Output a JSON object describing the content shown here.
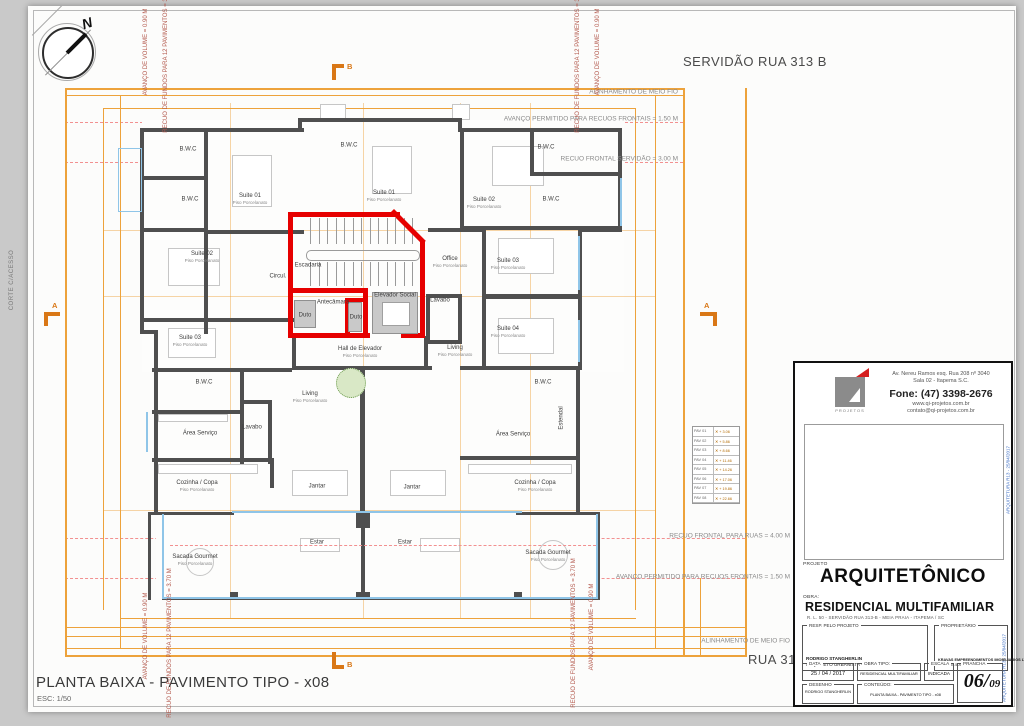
{
  "sheet": {
    "plan_title": "PLANTA BAIXA - PAVIMENTO TIPO - x08",
    "scale_label": "ESC: 1/50",
    "edge_label": "CORTE C/ACESSO",
    "compass_label": "N"
  },
  "streets": {
    "top": "SERVIDÃO RUA 313 B",
    "bottom": "RUA 315"
  },
  "margin_notes": [
    {
      "text": "ALINHAMENTO DE MEIO FIO",
      "x": 678,
      "y": 92
    },
    {
      "text": "AVANÇO PERMITIDO PARA RECUOS FRONTAIS = 1.50 M",
      "x": 678,
      "y": 119
    },
    {
      "text": "RECUO FRONTAL SERVIDÃO = 3.00 M",
      "x": 678,
      "y": 159
    },
    {
      "text": "RECUO FRONTAL PARA RUAS = 4.00 M",
      "x": 790,
      "y": 536
    },
    {
      "text": "AVANÇO PERMITIDO PARA RECUOS FRONTAIS = 1.50 M",
      "x": 790,
      "y": 577
    },
    {
      "text": "ALINHAMENTO DE MEIO FIO",
      "x": 790,
      "y": 641
    }
  ],
  "vertical_notes": [
    {
      "text": "AVANÇO DE VOLUME = 0.90 M",
      "x": 146,
      "y": 52
    },
    {
      "text": "RECUO DE FUNDOS PARA 12 PAVIMENTOS = 3.70 M",
      "x": 166,
      "y": 58
    },
    {
      "text": "RECUO DE FUNDOS PARA 12 PAVIMENTOS = 3.70 M",
      "x": 578,
      "y": 58
    },
    {
      "text": "AVANÇO DE VOLUME = 0.90 M",
      "x": 598,
      "y": 52
    },
    {
      "text": "AVANÇO DE VOLUME = 0.90 M",
      "x": 146,
      "y": 636
    },
    {
      "text": "RECUO DE FUNDOS PARA 12 PAVIMENTOS = 3.70 M",
      "x": 170,
      "y": 643
    },
    {
      "text": "RECUO DE FUNDOS PARA 12 PAVIMENTOS = 3.70 M",
      "x": 574,
      "y": 633
    },
    {
      "text": "AVANÇO DE VOLUME = 0.90 M",
      "x": 592,
      "y": 627
    }
  ],
  "section_markers": [
    {
      "label": "A",
      "x": 44,
      "y": 312,
      "dir": "left"
    },
    {
      "label": "A",
      "x": 700,
      "y": 312,
      "dir": "right"
    },
    {
      "label": "B",
      "x": 332,
      "y": 64,
      "dir": "top"
    },
    {
      "label": "B",
      "x": 332,
      "y": 652,
      "dir": "bottom"
    }
  ],
  "rooms": [
    {
      "name": "B.W.C",
      "x": 188,
      "y": 150
    },
    {
      "name": "B.W.C",
      "x": 190,
      "y": 200
    },
    {
      "name": "Suite 01",
      "x": 250,
      "y": 199,
      "sub": "Piso Porcelanato"
    },
    {
      "name": "B.W.C",
      "x": 349,
      "y": 146
    },
    {
      "name": "Suite 01",
      "x": 384,
      "y": 196,
      "sub": "Piso Porcelanato"
    },
    {
      "name": "Suite 02",
      "x": 202,
      "y": 257,
      "sub": "Piso Porcelanato"
    },
    {
      "name": "Suite 03",
      "x": 190,
      "y": 341,
      "sub": "Piso Porcelanato"
    },
    {
      "name": "Circul.",
      "x": 278,
      "y": 277
    },
    {
      "name": "Escadaria",
      "x": 308,
      "y": 266
    },
    {
      "name": "Antecâmara",
      "x": 333,
      "y": 303
    },
    {
      "name": "Duto",
      "x": 305,
      "y": 316
    },
    {
      "name": "Duto",
      "x": 356,
      "y": 318
    },
    {
      "name": "Elevador Social",
      "x": 395,
      "y": 296
    },
    {
      "name": "Hall de Elevador",
      "x": 360,
      "y": 352,
      "sub": "Piso Porcelanato"
    },
    {
      "name": "Office",
      "x": 450,
      "y": 262,
      "sub": "Piso Porcelanato"
    },
    {
      "name": "Lavabo",
      "x": 440,
      "y": 301
    },
    {
      "name": "Living",
      "x": 455,
      "y": 351,
      "sub": "Piso Porcelanato"
    },
    {
      "name": "B.W.C",
      "x": 546,
      "y": 148
    },
    {
      "name": "Suite 02",
      "x": 484,
      "y": 203,
      "sub": "Piso Porcelanato"
    },
    {
      "name": "B.W.C",
      "x": 551,
      "y": 200
    },
    {
      "name": "Suite 03",
      "x": 508,
      "y": 264,
      "sub": "Piso Porcelanato"
    },
    {
      "name": "Suite 04",
      "x": 508,
      "y": 332,
      "sub": "Piso Porcelanato"
    },
    {
      "name": "B.W.C",
      "x": 204,
      "y": 383
    },
    {
      "name": "Área Serviço",
      "x": 200,
      "y": 434
    },
    {
      "name": "Lavabo",
      "x": 252,
      "y": 428
    },
    {
      "name": "Living",
      "x": 310,
      "y": 397,
      "sub": "Piso Porcelanato"
    },
    {
      "name": "Cozinha / Copa",
      "x": 197,
      "y": 486,
      "sub": "Piso Porcelanato"
    },
    {
      "name": "Jantar",
      "x": 317,
      "y": 487
    },
    {
      "name": "Jantar",
      "x": 412,
      "y": 488
    },
    {
      "name": "Estar",
      "x": 317,
      "y": 543
    },
    {
      "name": "Estar",
      "x": 405,
      "y": 543
    },
    {
      "name": "Sacada Gourmet",
      "x": 195,
      "y": 560,
      "sub": "Piso Porcelanato"
    },
    {
      "name": "B.W.C",
      "x": 543,
      "y": 383
    },
    {
      "name": "Estendal",
      "x": 562,
      "y": 418,
      "rot": true
    },
    {
      "name": "Área Serviço",
      "x": 513,
      "y": 435
    },
    {
      "name": "Cozinha / Copa",
      "x": 535,
      "y": 486,
      "sub": "Piso Porcelanato"
    },
    {
      "name": "Sacada Gourmet",
      "x": 548,
      "y": 556,
      "sub": "Piso Porcelanato"
    }
  ],
  "levels_table": {
    "rows": [
      [
        "PAV 01",
        "+ 3.06"
      ],
      [
        "PAV 02",
        "+ 5.86"
      ],
      [
        "PAV 03",
        "+ 8.66"
      ],
      [
        "PAV 04",
        "+ 11.46"
      ],
      [
        "PAV 05",
        "+ 14.26"
      ],
      [
        "PAV 06",
        "+ 17.06"
      ],
      [
        "PAV 07",
        "+ 19.86"
      ],
      [
        "PAV 08",
        "+ 22.66"
      ]
    ]
  },
  "title_block": {
    "logo_caption": "PROJETOS",
    "address1": "Av. Nereu Ramos esq. Rua 208 nº 3040",
    "address2": "Sala 02 - Itapema S.C.",
    "phone": "Fone: (47) 3398-2676",
    "site": "www.qi-projetos.com.br",
    "email": "contato@qi-projetos.com.br",
    "projeto_label": "PROJETO",
    "projeto": "ARQUITETÔNICO",
    "obra_label": "OBRA:",
    "obra": "RESIDENCIAL MULTIFAMILIAR",
    "obra_sub": "R. L. 50 - SERVIDÃO RUA 313-B - MEIA PRAIA - ITAPEMA / SC",
    "resp_label": "RESP. PELO PROJETO",
    "resp_line1": "RODRIGO STANGHERLIN",
    "resp_line2": "ARQUITETO URBANISTA - CAU A48954",
    "prop_label": "PROPRIETÁRIO",
    "prop_line1": "KRAVAS EMPREENDIMENTOS IMOBILIARIOS LTDA",
    "prop_line2": "CNPJ: 05.505.505/0001-05",
    "data_label": "DATA",
    "data_value": "25 / 04 / 2017",
    "tipo_label": "OBRA  TIPO:",
    "tipo_value": "RESIDENCIAL MULTIFAMILIAR",
    "escala_label": "ESCALA",
    "escala_value": "INDICADA",
    "prancha_label": "PRANCHA",
    "prancha_big": "06/",
    "prancha_small": "09",
    "desenho_label": "DESENHO",
    "desenho_value": "RODRIGO STANGHERLIN",
    "conteudo_label": "CONTEÚDO:",
    "conteudo_value": "PLANTA BAIXA - PAVIMENTO TIPO - x08",
    "side_note": "ARQUITETURA R13 - 25/04/2017"
  },
  "colors": {
    "dimension_orange": "#eda23b",
    "marker_orange": "#d97716",
    "wall_gray": "#4f4f4f",
    "core_red": "#e60000",
    "glass_blue": "#8fc5e8",
    "setback_dashed_red": "#f29090"
  }
}
